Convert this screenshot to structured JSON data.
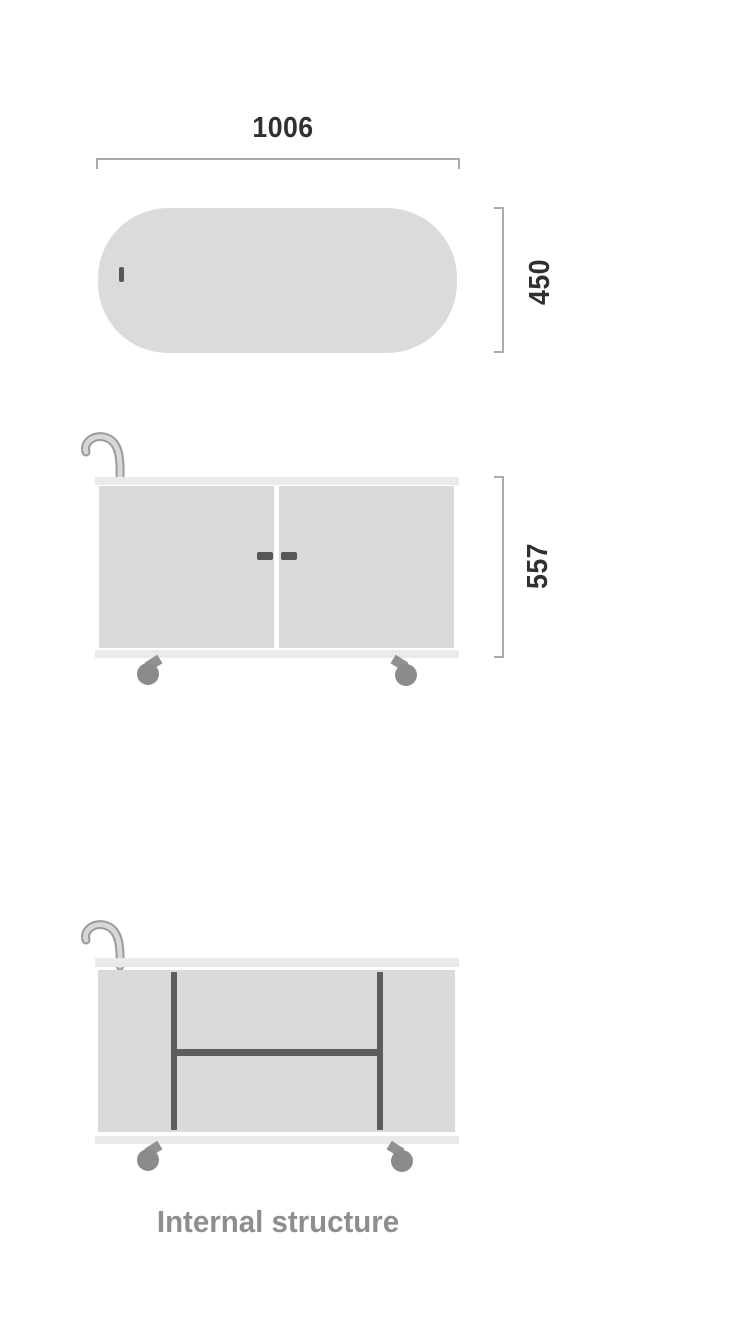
{
  "diagram": {
    "type": "furniture-dimension-drawing",
    "subject": "mobile cabinet / trolley with casters",
    "views": {
      "top": {
        "name": "top view (plan)",
        "width_label": "1006",
        "depth_label": "450"
      },
      "front": {
        "name": "front view (double doors, casters, push handle)",
        "height_label": "557"
      },
      "internal": {
        "name": "internal structure view",
        "caption": "Internal structure"
      }
    },
    "dimensions_shown": [
      "1006",
      "450",
      "557"
    ],
    "colors": {
      "background": "#ffffff",
      "panel_fill": "#d9dbda",
      "pill_fill": "#dadcdb",
      "strip_fill": "#e9eaea",
      "divider_dark": "#5c5e5d",
      "wheel_gray": "#8a8c8b",
      "bracket_gray": "#a8abaa",
      "dimension_text": "#2f3030",
      "caption_gray": "#8d8f8e",
      "handle_outline": "#9a9c9b",
      "handle_fill": "#d6d8d7"
    },
    "icons": [
      "trolley-handle-icon",
      "caster-wheel",
      "door-handle"
    ]
  }
}
